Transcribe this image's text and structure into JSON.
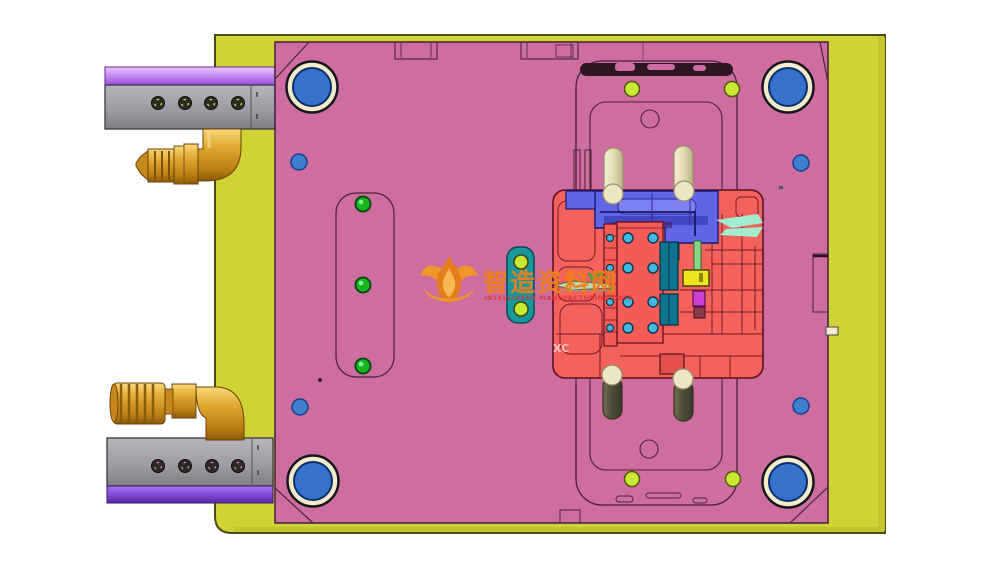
{
  "viewport": {
    "background": "#ffffff"
  },
  "watermark": {
    "logo_icon": "flame-logo-icon",
    "title": "智造资料网",
    "subtitle": "INTELLIGENT MANUFACTURING DATA"
  },
  "labels": {
    "yc": "YC",
    "xc": "XC"
  },
  "colors": {
    "base_plate": "#cfd335",
    "base_plate_edge": "#c2c52c",
    "main_plate": "#cd6da0",
    "core_red": "#f3625c",
    "insert_red": "#f25b56",
    "slider_blue": "#6065e5",
    "slider_blue_light": "#7b80f0",
    "slider_blue_dark": "#4347c2",
    "teal_bar": "#0f7490",
    "dark_teal": "#0b6478",
    "cyan_hole": "#3fb9de",
    "lime_hole": "#c8e832",
    "green_ball": "#16b822",
    "coolant_bar_teal": "#18989e",
    "mint_highlight": "#a2ecd0",
    "green_bar": "#86d98a",
    "yellow_block": "#f0e41c",
    "magenta_block": "#cc3fd0",
    "pin_cream": "#ece6c4",
    "pin_olive": "#55553c",
    "bushing_blue": "#3472cb",
    "bushing_ring": "#f2ecca",
    "hole_blue": "#3f7fd0",
    "rail_gray": "#9c9ca2",
    "rail_purple": "#a862e8",
    "rail_purple_dark": "#7a3fd8",
    "fitting_gold": "#e0a62e",
    "watermark_orange": "#f08018",
    "watermark_red": "#e03030",
    "label_green": "#0bbb33",
    "label_pink": "#ffcdd6"
  }
}
